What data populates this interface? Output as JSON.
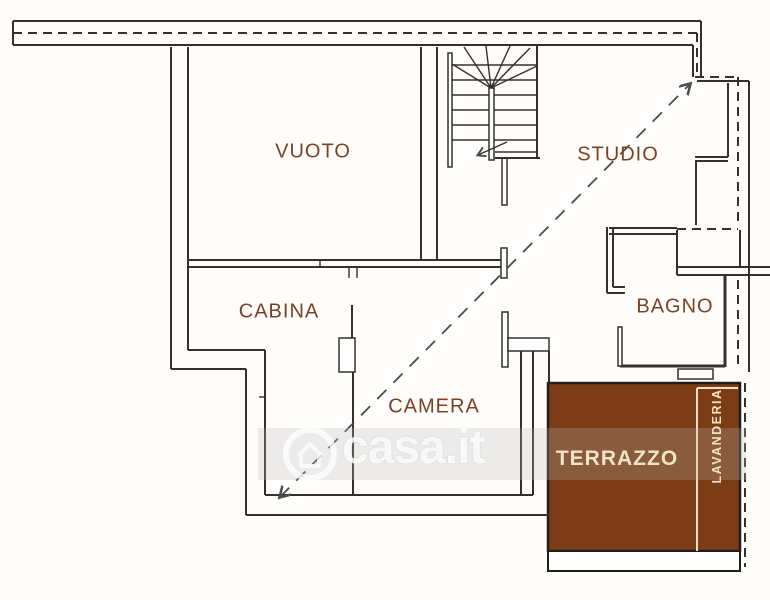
{
  "plan": {
    "rooms": [
      {
        "id": "vuoto",
        "label": "VUOTO"
      },
      {
        "id": "studio",
        "label": "STUDIO"
      },
      {
        "id": "cabina",
        "label": "CABINA"
      },
      {
        "id": "camera",
        "label": "CAMERA"
      },
      {
        "id": "bagno",
        "label": "BAGNO"
      },
      {
        "id": "terrazzo",
        "label": "TERRAZZO"
      },
      {
        "id": "lavanderia",
        "label": "LAVANDERIA"
      }
    ],
    "colors": {
      "line": "#34312a",
      "label_brown": "#7c4122",
      "terrace_fill": "#7b3c16",
      "terrace_text": "#f2e4c3"
    }
  },
  "watermark": {
    "text": "casa.it",
    "logo": "house-in-circle-icon"
  }
}
